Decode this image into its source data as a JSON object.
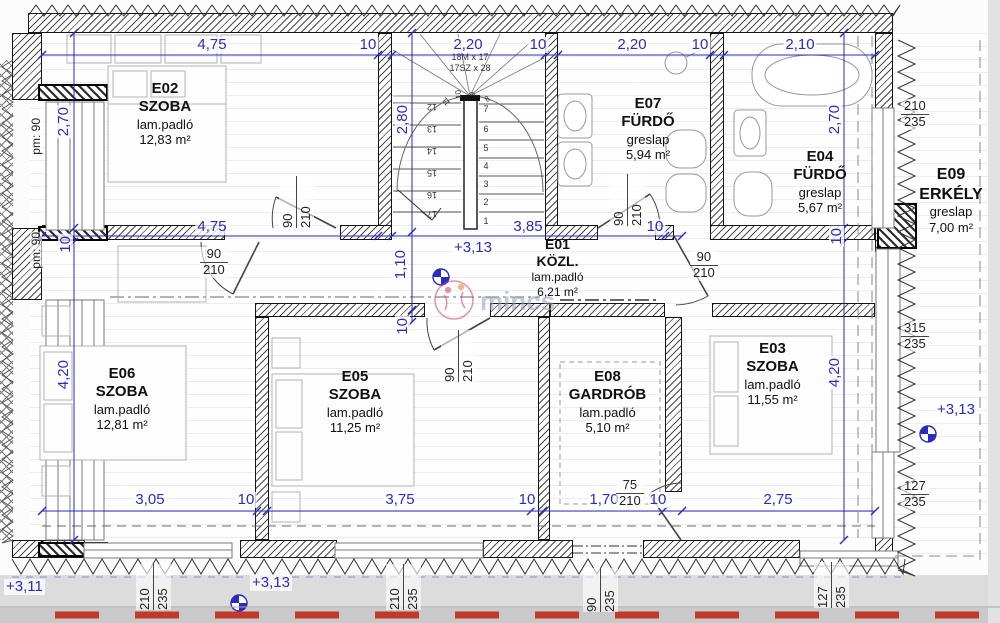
{
  "colors": {
    "dimension_blue": "#2b2bbd",
    "size_label": "#222222",
    "wall_dark": "#141414",
    "red_dash": "#c0392b",
    "watermark_red": "#cc4466",
    "ground_gray": "#dcdcdc"
  },
  "rooms": [
    {
      "id": "E02",
      "type": "SZOBA",
      "floor": "lam.padló",
      "area": "12,83 m²"
    },
    {
      "id": "E07",
      "type": "FÜRDŐ",
      "floor": "greslap",
      "area": "5,94 m²"
    },
    {
      "id": "E04",
      "type": "FÜRDŐ",
      "floor": "greslap",
      "area": "5,67 m²"
    },
    {
      "id": "E09",
      "type": "ERKÉLY",
      "floor": "greslap",
      "area": "7,00 m²"
    },
    {
      "id": "E01",
      "type": "KÖZL.",
      "floor": "lam.padló",
      "area": "6,21 m²"
    },
    {
      "id": "E06",
      "type": "SZOBA",
      "floor": "lam.padló",
      "area": "12,81 m²"
    },
    {
      "id": "E05",
      "type": "SZOBA",
      "floor": "lam.padló",
      "area": "11,25 m²"
    },
    {
      "id": "E08",
      "type": "GARDRÓB",
      "floor": "lam.padló",
      "area": "5,10 m²"
    },
    {
      "id": "E03",
      "type": "SZOBA",
      "floor": "lam.padló",
      "area": "11,55 m²"
    }
  ],
  "dims": {
    "top": [
      "4,75",
      "10",
      "2,20",
      "10",
      "2,20",
      "10",
      "2,10"
    ],
    "mid": [
      "4,75",
      "3,85",
      "10"
    ],
    "bottom": [
      "3,05",
      "10",
      "3,75",
      "10",
      "1,70",
      "10",
      "2,75"
    ],
    "left": [
      "2,70",
      "10",
      "4,20"
    ],
    "right": [
      "2,70",
      "10",
      "4,20"
    ],
    "inner": [
      "2,80",
      "1,10",
      "10"
    ]
  },
  "doors": {
    "e02": {
      "w": "90",
      "h": "210"
    },
    "e06": {
      "w": "90",
      "h": "210"
    },
    "e05": {
      "w": "90",
      "h": "210"
    },
    "e07": {
      "w": "90",
      "h": "210"
    },
    "e04": {
      "w": "90",
      "h": "210"
    },
    "e08": {
      "w": "75",
      "h": "210"
    }
  },
  "windows": {
    "bottom": [
      {
        "w": "210",
        "h": "235"
      },
      {
        "w": "210",
        "h": "235"
      },
      {
        "w": "90",
        "h": "235"
      },
      {
        "w": "127",
        "h": "235"
      }
    ],
    "right": [
      {
        "w": "210",
        "h": "235"
      },
      {
        "w": "315",
        "h": "235"
      },
      {
        "w": "127",
        "h": "235"
      }
    ]
  },
  "parapet": "pm: 90",
  "levels": {
    "hall": "+3,13",
    "right": "+3,13",
    "bottom": "+3,13",
    "outside": "+3,11"
  },
  "stairs": {
    "note1": "18M x 17",
    "note2": "17SZ x 28",
    "numbers": [
      "1",
      "2",
      "3",
      "4",
      "5",
      "6",
      "7",
      "8",
      "9",
      "10",
      "11",
      "12",
      "13",
      "14",
      "15",
      "16",
      "17"
    ]
  },
  "watermark": "mincs"
}
